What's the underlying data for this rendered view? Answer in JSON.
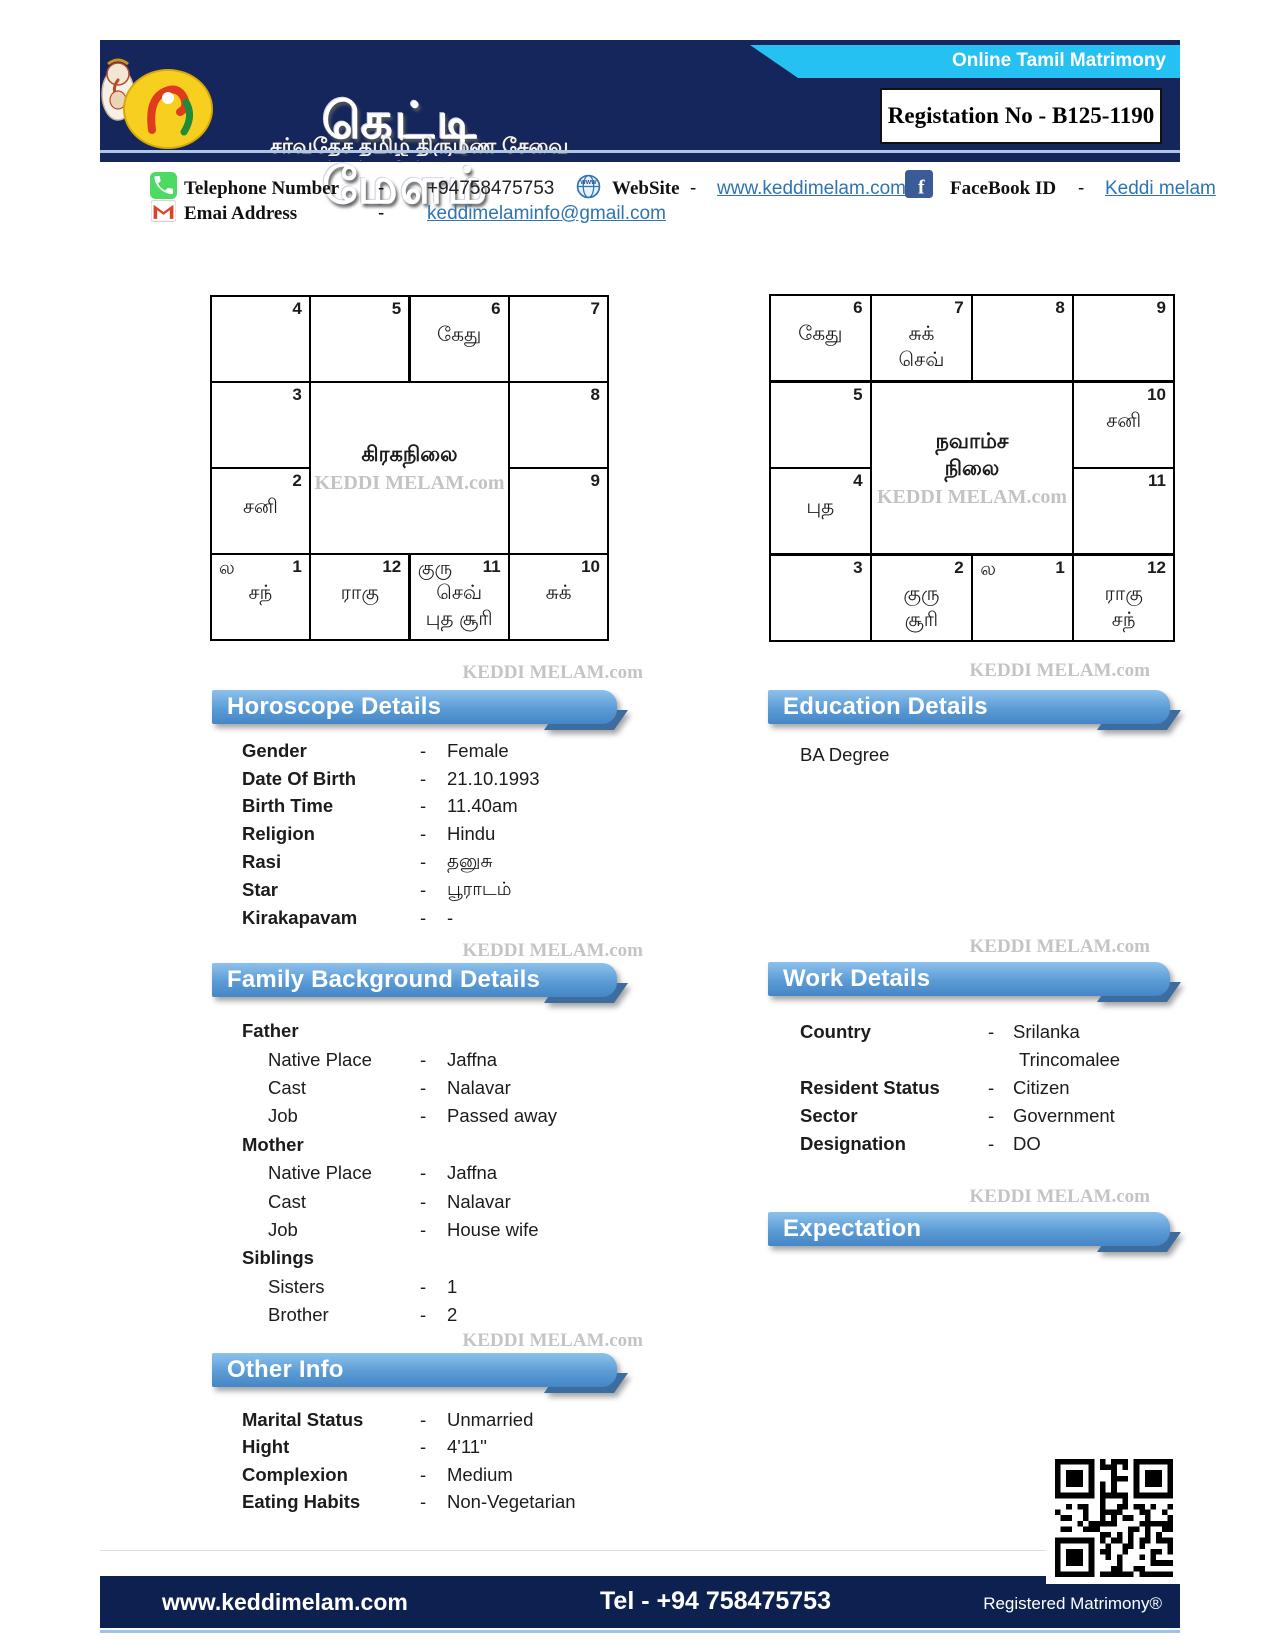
{
  "dash": "-",
  "watermark": "KEDDI MELAM.com",
  "header": {
    "ribbon_label": "Online Tamil Matrimony",
    "registration_label": "Registation No - B125-1190",
    "logo_title": "கெட்டி மேளம்",
    "logo_tagline": "சர்வதேச தமிழ் திருமண சேவை"
  },
  "contact": {
    "telephone": {
      "label": "Telephone Number",
      "value": "+94758475753"
    },
    "website": {
      "label": "WebSite",
      "value": "www.keddimelam.com"
    },
    "facebook": {
      "label": "FaceBook ID",
      "value": "Keddi melam"
    },
    "email": {
      "label": "Emai Address",
      "value": "keddimelaminfo@gmail.com"
    }
  },
  "charts": {
    "rasi": {
      "title": "கிரகநிலை",
      "cells": {
        "r0c0": {
          "num": "4"
        },
        "r0c1": {
          "num": "5"
        },
        "r0c2": {
          "num": "6",
          "l1": "கேது"
        },
        "r0c3": {
          "num": "7"
        },
        "r1c0": {
          "num": "3"
        },
        "r1c3": {
          "num": "8"
        },
        "r2c0": {
          "num": "2",
          "l1": "சனி"
        },
        "r2c3": {
          "num": "9"
        },
        "r3c0": {
          "tl": "ல",
          "num": "1",
          "l1": "சந்"
        },
        "r3c1": {
          "num": "12",
          "l1": "ராகு"
        },
        "r3c2": {
          "tl": "குரு",
          "num": "11",
          "l1": "செவ்",
          "l2": "புத சூரி"
        },
        "r3c3": {
          "num": "10",
          "l1": "சுக்"
        }
      }
    },
    "navamsa": {
      "title_line1": "நவாம்ச",
      "title_line2": "நிலை",
      "cells": {
        "r0c0": {
          "num": "6",
          "l1": "கேது"
        },
        "r0c1": {
          "num": "7",
          "l1": "சுக்",
          "l2": "செவ்"
        },
        "r0c2": {
          "num": "8"
        },
        "r0c3": {
          "num": "9"
        },
        "r1c0": {
          "num": "5"
        },
        "r1c3": {
          "num": "10",
          "l1": "சனி"
        },
        "r2c0": {
          "num": "4",
          "l1": "புத"
        },
        "r2c3": {
          "num": "11"
        },
        "r3c0": {
          "num": "3"
        },
        "r3c1": {
          "num": "2",
          "l1": "குரு",
          "l2": "சூரி"
        },
        "r3c2": {
          "tl": "ல",
          "num": "1"
        },
        "r3c3": {
          "num": "12",
          "l1": "ராகு",
          "l2": "சந்"
        }
      }
    }
  },
  "sections": {
    "horoscope": {
      "title": "Horoscope Details",
      "rows": [
        {
          "label": "Gender",
          "value": "Female"
        },
        {
          "label": "Date Of Birth",
          "value": "21.10.1993"
        },
        {
          "label": "Birth Time",
          "value": "11.40am"
        },
        {
          "label": "Religion",
          "value": "Hindu"
        },
        {
          "label": "Rasi",
          "value": "தனுசு"
        },
        {
          "label": "Star",
          "value": "பூராடம்"
        },
        {
          "label": "Kirakapavam",
          "value": "-"
        }
      ]
    },
    "education": {
      "title": "Education Details",
      "content": "BA Degree"
    },
    "family": {
      "title": "Family Background Details",
      "groups": [
        {
          "heading": "Father",
          "rows": [
            {
              "label": "Native Place",
              "value": "Jaffna"
            },
            {
              "label": "Cast",
              "value": "Nalavar"
            },
            {
              "label": "Job",
              "value": "Passed away"
            }
          ]
        },
        {
          "heading": "Mother",
          "rows": [
            {
              "label": "Native Place",
              "value": "Jaffna"
            },
            {
              "label": "Cast",
              "value": "Nalavar"
            },
            {
              "label": "Job",
              "value": "House wife"
            }
          ]
        },
        {
          "heading": "Siblings",
          "rows": [
            {
              "label": "Sisters",
              "value": "1"
            },
            {
              "label": "Brother",
              "value": "2"
            }
          ]
        }
      ]
    },
    "work": {
      "title": "Work Details",
      "rows": [
        {
          "label": "Country",
          "value": "Srilanka"
        },
        {
          "label": "",
          "value": "Trincomalee",
          "nodash": true
        },
        {
          "label": "Resident Status",
          "value": "Citizen"
        },
        {
          "label": "Sector",
          "value": "Government"
        },
        {
          "label": "Designation",
          "value": "DO"
        }
      ]
    },
    "expectation": {
      "title": "Expectation"
    },
    "other": {
      "title": "Other Info",
      "rows": [
        {
          "label": "Marital Status",
          "value": "Unmarried"
        },
        {
          "label": "Hight",
          "value": "4'11''"
        },
        {
          "label": "Complexion",
          "value": "Medium"
        },
        {
          "label": "Eating Habits",
          "value": "Non-Vegetarian"
        }
      ]
    }
  },
  "footer": {
    "website": "www.keddimelam.com",
    "tel": "Tel - +94 758475753",
    "registered": "Registered Matrimony®"
  }
}
